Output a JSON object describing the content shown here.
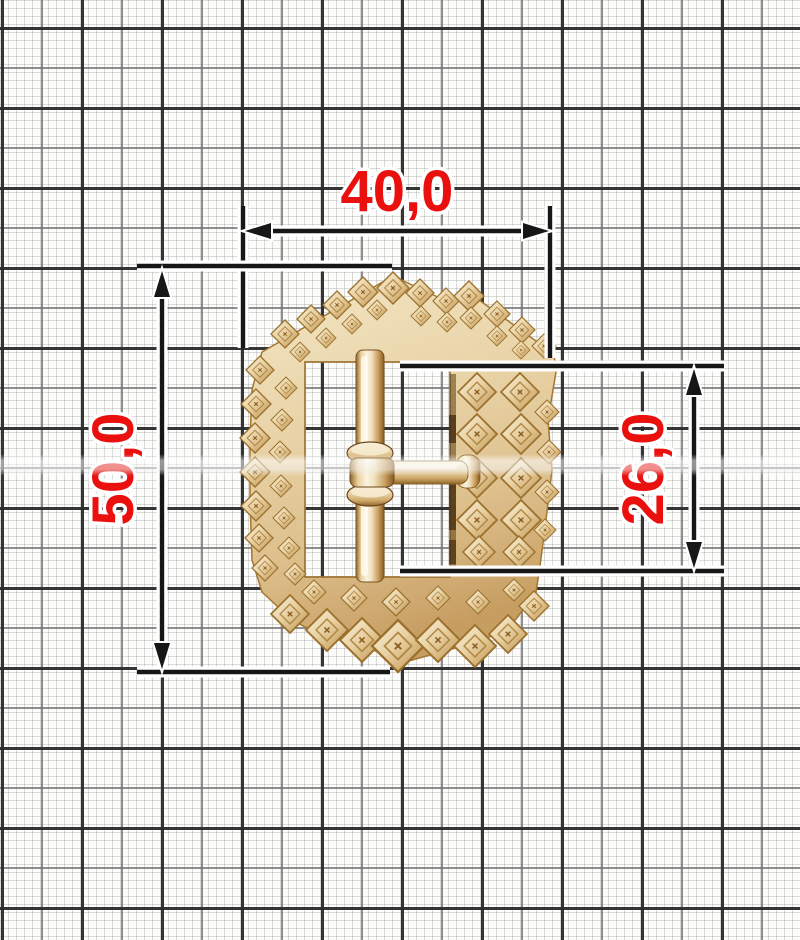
{
  "figure": {
    "description": "Ornate gold belt buckle with pin, photographed on millimeter graph paper with red dimension callouts"
  },
  "dimensions": {
    "width": {
      "label": "40,0"
    },
    "height": {
      "label": "50,0"
    },
    "inner_height": {
      "label": "26,0"
    }
  },
  "colors": {
    "dimension_text": "#e9100d",
    "dimension_lines": "#171717",
    "halo": "#ffffff",
    "paper": "#fcfcfb",
    "grid_fine": "#d7d7d7",
    "grid_medium": "#8f8f8f",
    "grid_bold": "#2a2a2a",
    "gold_light": "#faf3e0",
    "gold_mid": "#e9d2a4",
    "gold_deep": "#bf934f",
    "gold_shadow": "#7a5222"
  }
}
